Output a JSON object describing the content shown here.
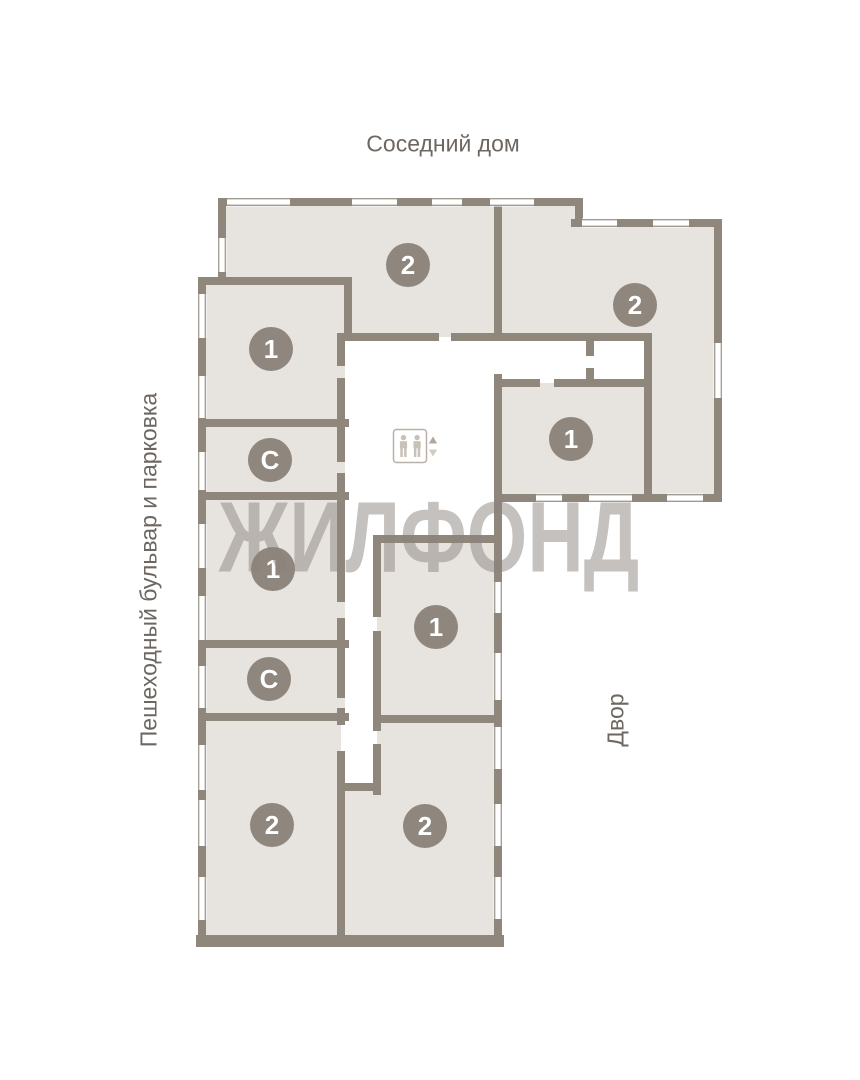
{
  "surroundings": {
    "top_label": "Соседний дом",
    "left_label": "Пешеходный бульвар и парковка",
    "right_label": "Двор"
  },
  "watermark": {
    "text": "ЖИЛФОНД"
  },
  "floor_plan": {
    "badges": [
      {
        "id": "top-2",
        "label": "2"
      },
      {
        "id": "right-2",
        "label": "2"
      },
      {
        "id": "left-1-upper",
        "label": "1"
      },
      {
        "id": "right-1",
        "label": "1"
      },
      {
        "id": "left-storage-upper",
        "label": "С"
      },
      {
        "id": "left-1-lower",
        "label": "1"
      },
      {
        "id": "middle-1",
        "label": "1"
      },
      {
        "id": "left-storage-lower",
        "label": "С"
      },
      {
        "id": "bottom-left-2",
        "label": "2"
      },
      {
        "id": "bottom-middle-2",
        "label": "2"
      }
    ],
    "elevator": {
      "icon": "elevator-people-icon",
      "up": "arrow-up-icon",
      "down": "arrow-down-icon"
    }
  },
  "colors": {
    "wall": "#8f877c",
    "room_fill": "#e7e4e0",
    "badge": "#8f877d",
    "badge_text": "#ffffff",
    "window_line": "#a29a90",
    "label_text": "#6e6761",
    "watermark": "#8c847d"
  }
}
